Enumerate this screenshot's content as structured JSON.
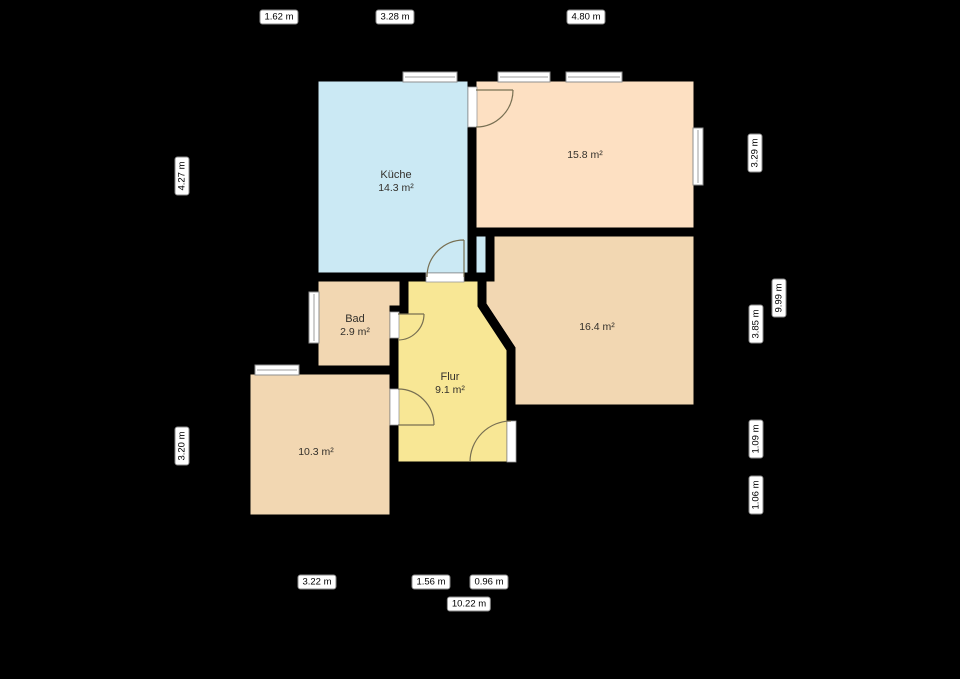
{
  "plan": {
    "rooms": [
      {
        "id": "kueche",
        "name": "Küche",
        "area": "14.3 m²",
        "color": "#cbe9f4"
      },
      {
        "id": "room15",
        "name": "",
        "area": "15.8 m²",
        "color": "#fde0c2"
      },
      {
        "id": "bad",
        "name": "Bad",
        "area": "2.9 m²",
        "color": "#f2d7b2"
      },
      {
        "id": "flur",
        "name": "Flur",
        "area": "9.1 m²",
        "color": "#f8e795"
      },
      {
        "id": "room16",
        "name": "",
        "area": "16.4 m²",
        "color": "#f2d7b2"
      },
      {
        "id": "room10",
        "name": "",
        "area": "10.3 m²",
        "color": "#f2d7b2"
      }
    ],
    "dimensions": {
      "top": [
        {
          "label": "1.62 m"
        },
        {
          "label": "3.28 m"
        },
        {
          "label": "4.80 m"
        }
      ],
      "left": [
        {
          "label": "4.27 m"
        },
        {
          "label": "3.20 m"
        }
      ],
      "right": [
        {
          "label": "3.29 m"
        },
        {
          "label": "9.99 m"
        },
        {
          "label": "3.85 m"
        },
        {
          "label": "1.09 m"
        },
        {
          "label": "1.06 m"
        }
      ],
      "bottom": [
        {
          "label": "3.22 m"
        },
        {
          "label": "1.56 m"
        },
        {
          "label": "0.96 m"
        },
        {
          "label": "10.22 m"
        }
      ]
    },
    "colors": {
      "background": "#000000",
      "wall": "#000000",
      "kitchen_fill": "#cbe9f4",
      "room15_fill": "#fde0c2",
      "tan_fill": "#f2d7b2",
      "hall_fill": "#f8e795",
      "door_arc": "#776f52",
      "window_frame": "#8f8f8f",
      "window_fill": "#ffffff",
      "label_text": "#33302b"
    }
  }
}
